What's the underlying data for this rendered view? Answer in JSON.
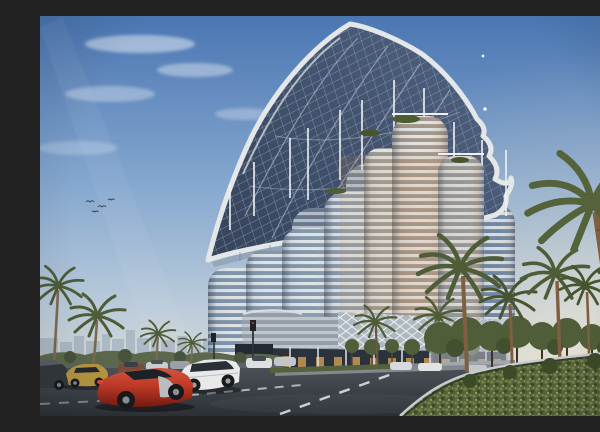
{
  "scene": {
    "alt": "Architectural rendering of a futuristic high-rise: a cluster of rounded glass towers with white floor bands beneath a huge curved grid-shell canopy, blue sky, palm trees, landscaped median hedge, wet asphalt road with white lane dashes, a red sports car, a white sedan, a gold coupe and parked cars in the foreground, hazy city skyline on the left horizon",
    "objects": [
      "sky",
      "clouds",
      "sun-glow",
      "birds",
      "city-skyline",
      "grid-shell-canopy",
      "roof-masts",
      "glass-towers",
      "green-roof-gardens",
      "podium-diagrid",
      "podium-louver-veil",
      "ground-floor-glass",
      "street-trees",
      "palm-trees",
      "median-hedge",
      "curb",
      "road",
      "lane-markings",
      "parking-lot",
      "red-sports-car",
      "white-sedan",
      "gold-coupe",
      "dark-coupe",
      "parked-cars",
      "traffic-lights"
    ]
  },
  "palette": {
    "sky_top": "#4a76b2",
    "sky_mid": "#85a7cf",
    "sky_horizon": "#d9dcd8",
    "warm_glow": "#f5e7c8",
    "canopy_dark": "#3e4e66",
    "canopy_grid": "#8ea2b8",
    "canopy_rim": "#e4e7e8",
    "tower_band": "#e8ebed",
    "tower_glass_cool": "#7e93a9",
    "tower_glass_warm": "#a3968a",
    "podium_grid": "#aeb8c0",
    "ground_glass": "#2a323c",
    "window_warm": "#c89757",
    "palm_green": "#4e5c38",
    "tree_green": "#4f5d38",
    "hedge_green": "#55623a",
    "trunk_brown": "#7e5f42",
    "road_dark": "#2c3036",
    "road_light": "#4b5057",
    "marking_white": "#dce0e1",
    "curb_grey": "#c6cbce",
    "skyline_haze": "#9fadbb",
    "car_red": "#c03a26",
    "car_white": "#e8eaea",
    "car_gold": "#b7963f",
    "car_dark": "#34383d"
  }
}
